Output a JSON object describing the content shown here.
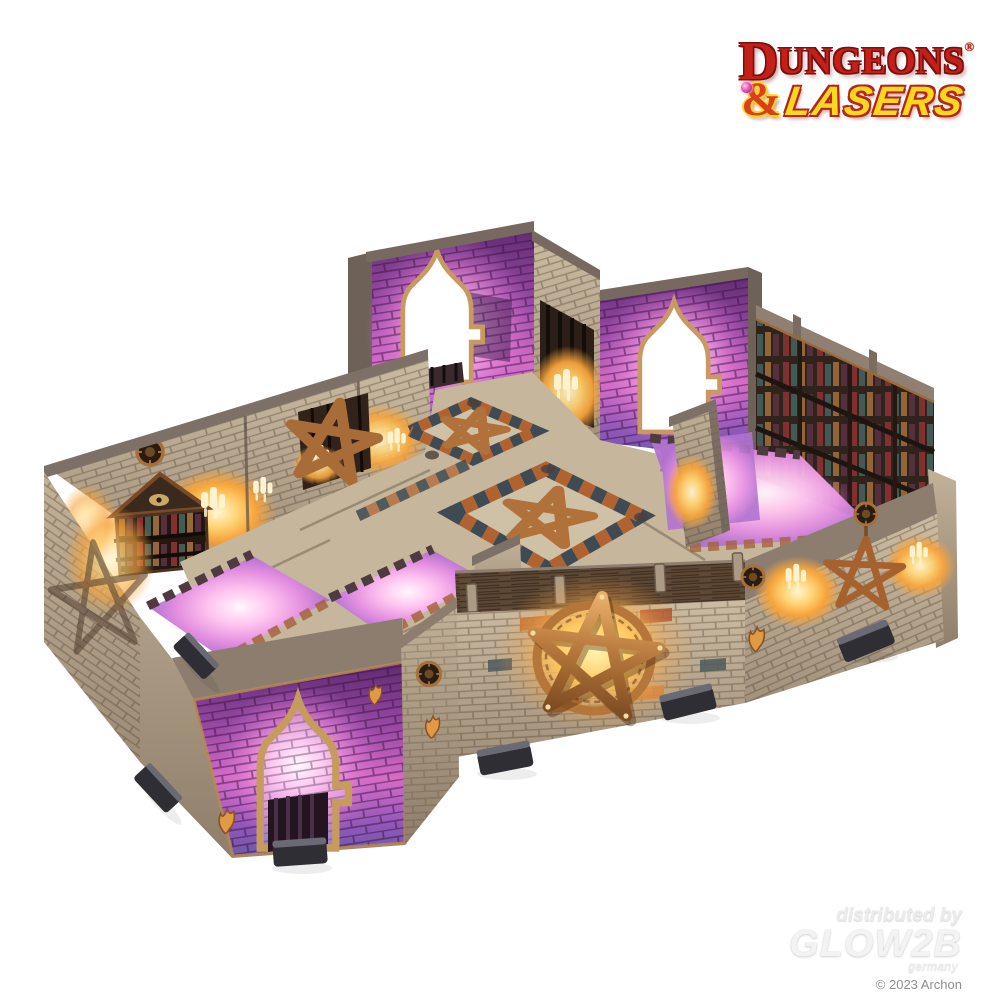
{
  "page": {
    "background_color": "#ffffff"
  },
  "logo": {
    "dungeons_initial": "D",
    "dungeons_rest": "UNGEONS",
    "registered": "®",
    "ampersand": "&",
    "lasers": "LASERS",
    "colors": {
      "red": "#c3201a",
      "dark_red": "#7a100e",
      "yellow": "#ffd71c"
    }
  },
  "watermark": {
    "line1": "distributed by",
    "brand": "GLOW2B",
    "country": "germany",
    "copyright": "© 2023 Archon"
  },
  "product_photo": {
    "subject": "dungeons-and-lasers-painted-modular-dungeon-terrain-set",
    "elements": [
      "stone-brick-walls",
      "gothic-arch-doorways",
      "copper-pentagram-emblems",
      "bookshelf-with-eye-pediment",
      "library-shelf-wall",
      "glowing-pink-floor-tiles",
      "checkered-pentagram-floor-tiles",
      "candle-glow-effects",
      "connector-clips"
    ],
    "colors": {
      "stone": "#b9a98f",
      "purple_glow": "#c95fc2",
      "pink_floor": "#f0a6e6",
      "orange_glow": "#f6a63e",
      "copper": "#b5763a",
      "wood_brown": "#5e4936",
      "clip_gray": "#36363c"
    }
  }
}
